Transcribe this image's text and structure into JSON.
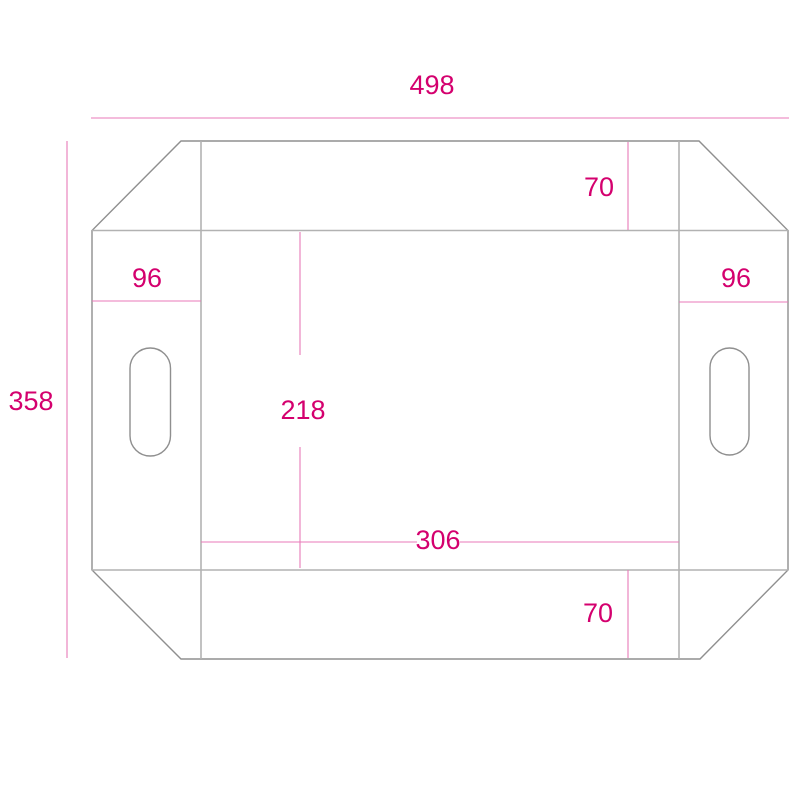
{
  "diagram": {
    "type": "packaging-dieline-technical-drawing",
    "labels": {
      "total_width": "498",
      "total_height": "358",
      "top_flap_depth": "70",
      "left_panel_width": "96",
      "right_panel_width": "96",
      "center_panel_height": "218",
      "center_panel_width": "306",
      "bottom_flap_depth": "70"
    },
    "colors": {
      "dimension_text": "#d4006e",
      "dimension_line": "#e87ab8",
      "cut_line": "#8f8f8f",
      "fold_line": "#b2b2b2",
      "background": "#ffffff"
    }
  }
}
